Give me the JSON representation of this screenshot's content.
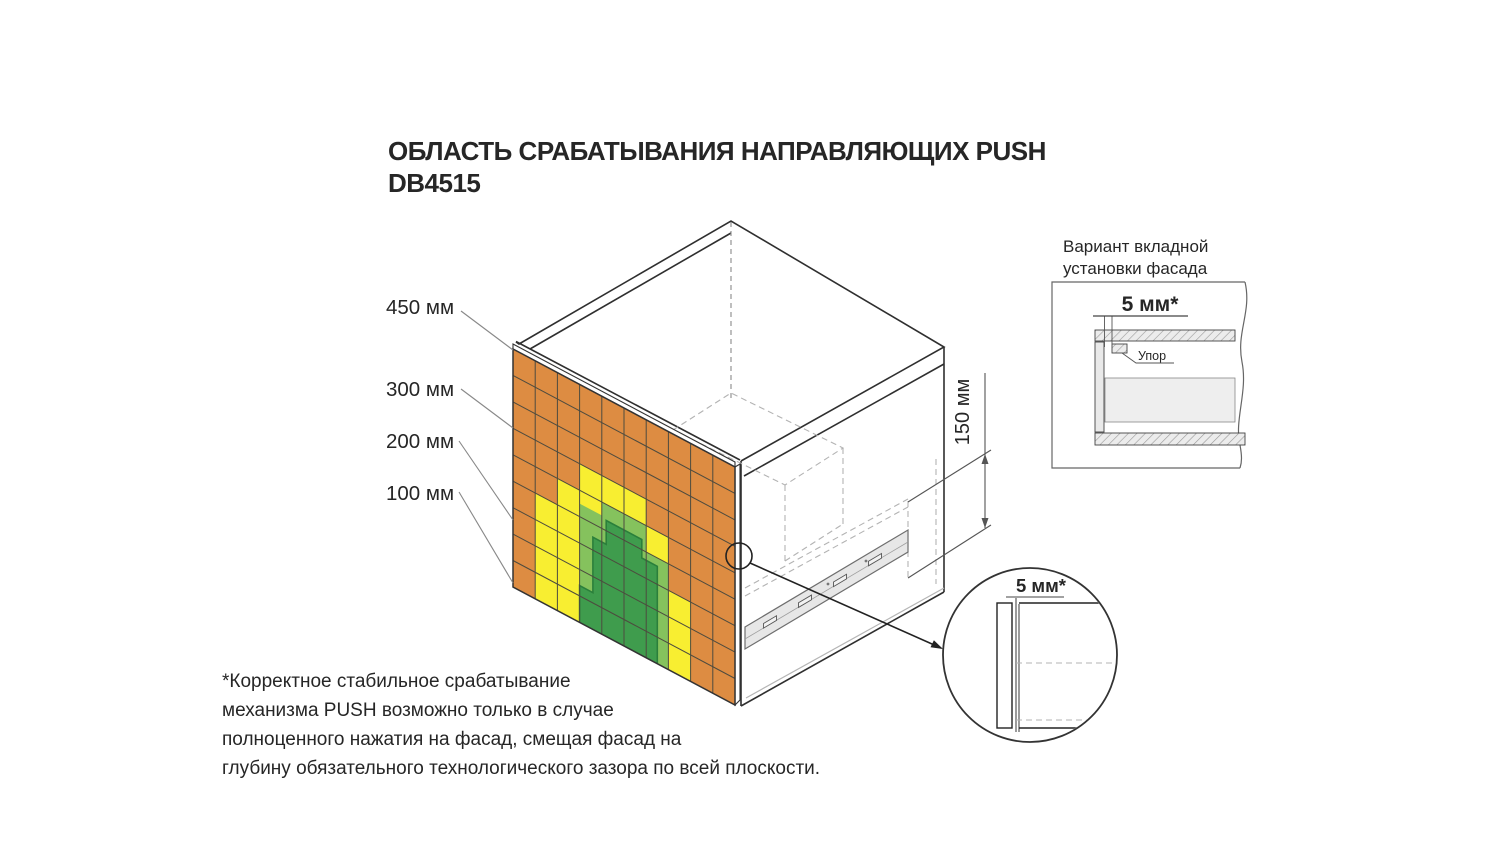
{
  "title": {
    "line1": "ОБЛАСТЬ СРАБАТЫВАНИЯ НАПРАВЛЯЮЩИХ PUSH",
    "line2": "DB4515"
  },
  "grid": {
    "columns": 10,
    "rows": 9
  },
  "zones": [
    {
      "label": "450 мм",
      "color": "#DD8C42",
      "name": "orange-zone"
    },
    {
      "label": "300 мм",
      "color": "#F8EE31",
      "name": "yellow-zone"
    },
    {
      "label": "200 мм",
      "color": "#85C25D",
      "name": "light-green-zone"
    },
    {
      "label": "100 мм",
      "color": "#3F9C4D",
      "name": "dark-green-zone"
    }
  ],
  "colors": {
    "dark_green_border": "#2B7F3B",
    "slide_fill": "#E7E7E7",
    "section_fill": "#ECECEC"
  },
  "dimensions": {
    "side_height": "150 мм",
    "inset_gap": "5 мм*",
    "circle_gap": "5 мм*",
    "stop_label": "Упор"
  },
  "inset": {
    "title_line1": "Вариант вкладной",
    "title_line2": "установки фасада"
  },
  "note": {
    "line1": "*Корректное стабильное срабатывание",
    "line2": "механизма PUSH возможно только в случае",
    "line3": "полноценного нажатия на фасад, смещая фасад на",
    "line4": "глубину обязательного технологического зазора по всей плоскости."
  }
}
